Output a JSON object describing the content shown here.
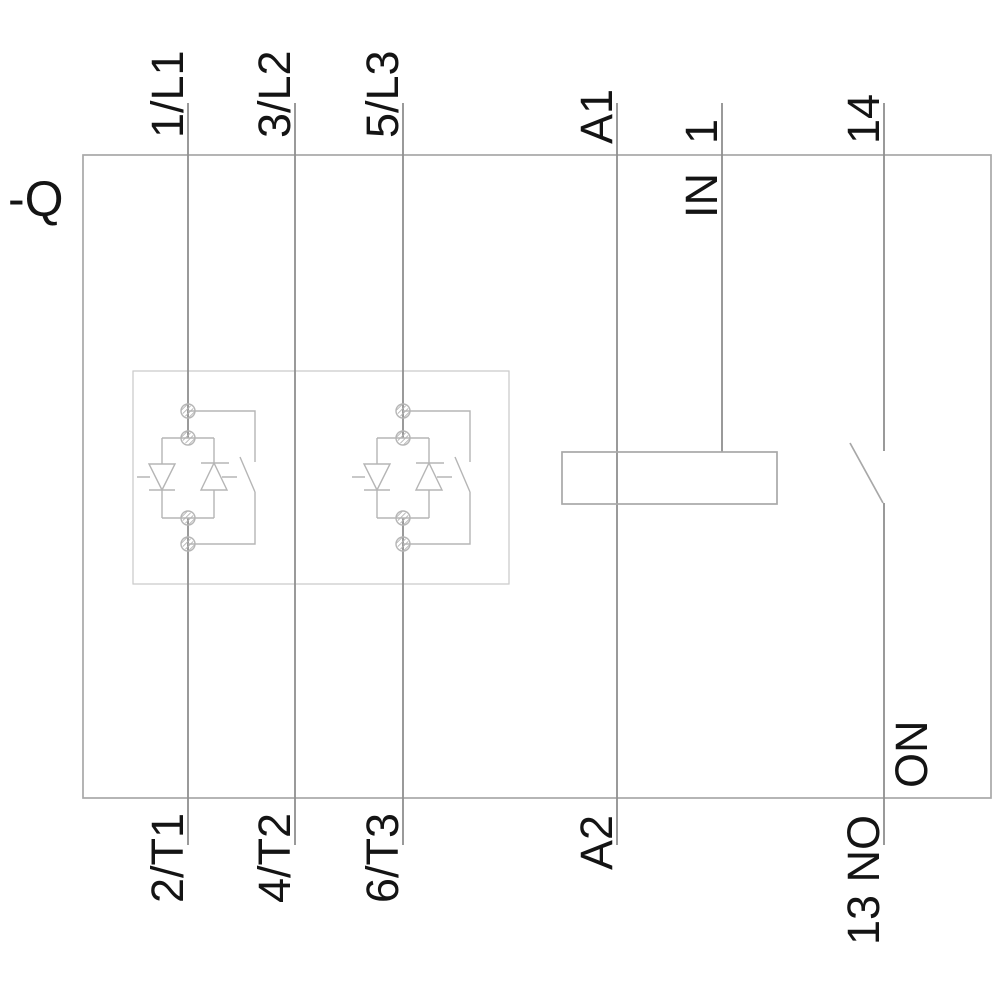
{
  "diagram": {
    "kind": "soft-starter-wiring-schematic",
    "device_tag": "-Q",
    "terminals": {
      "top": [
        {
          "label": "1/L1"
        },
        {
          "label": "3/L2"
        },
        {
          "label": "5/L3"
        },
        {
          "label": "A1"
        },
        {
          "label": "1",
          "sublabel": "IN"
        },
        {
          "label": "14"
        }
      ],
      "bottom": [
        {
          "label": "2/T1"
        },
        {
          "label": "4/T2"
        },
        {
          "label": "6/T3"
        },
        {
          "label": "A2"
        },
        {
          "label": "13 NO"
        }
      ]
    },
    "annotations": {
      "aux_contact": "ON"
    },
    "colors": {
      "background": "#ffffff",
      "text": "#141414",
      "line": "#8f8f8f",
      "outline": "#a8a8a8",
      "symbol": "#b5b5b5",
      "module_box": "#c9c9c9"
    }
  }
}
